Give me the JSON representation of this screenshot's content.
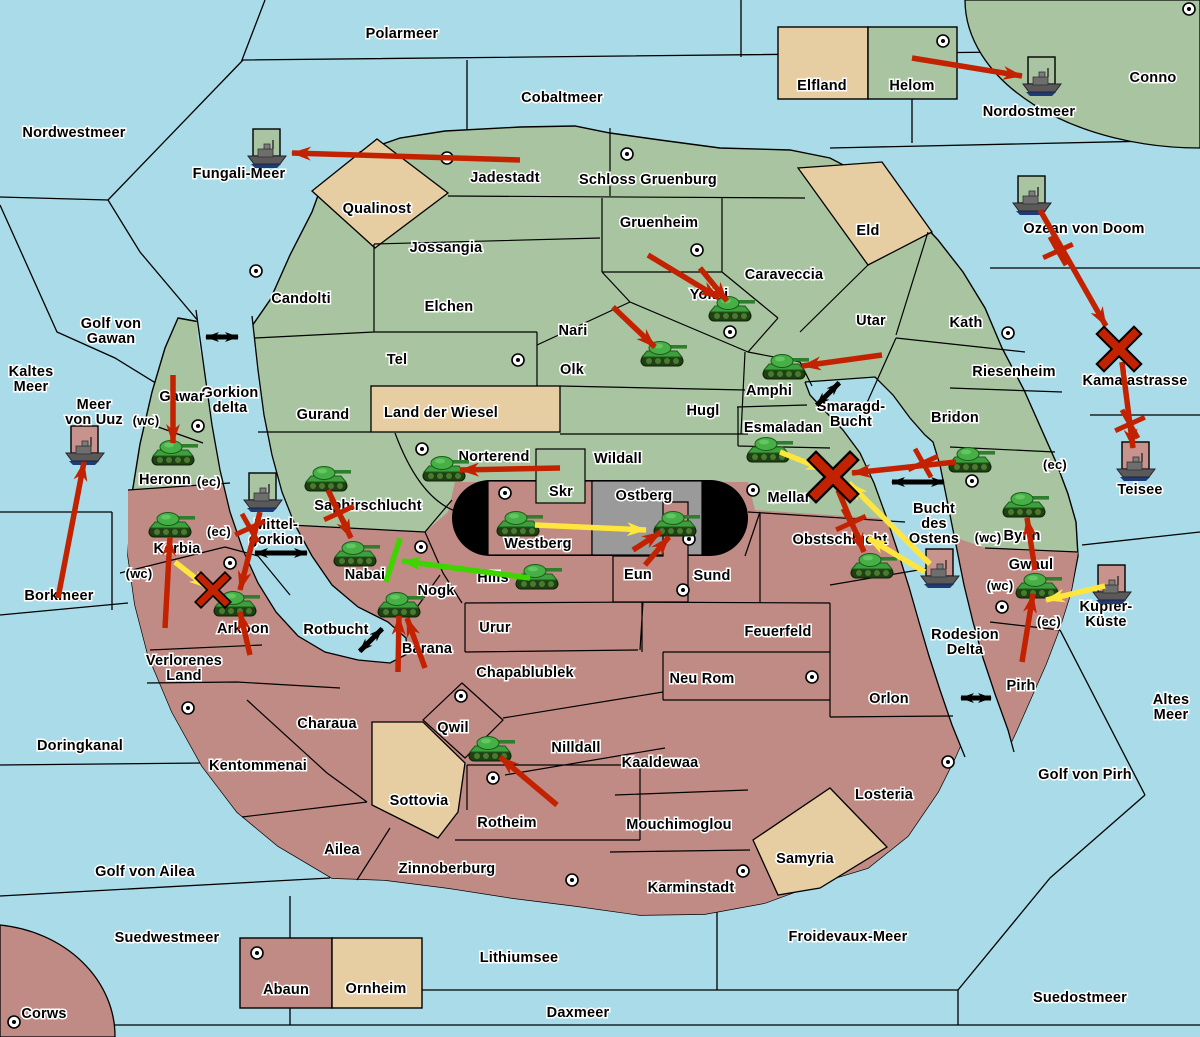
{
  "map": {
    "width": 1200,
    "height": 1037,
    "colors": {
      "sea": "#A9DCE8",
      "green_team_land": "#A9C4A0",
      "red_team_land": "#C08B85",
      "neutral_land": "#E6CDA2",
      "contested_gray": "#9A9A9A",
      "stadium_black": "#000000",
      "border": "#000000",
      "attack_arrow": "#C32200",
      "support_arrow": "#FFE63C",
      "friendly_arrow": "#3ED400",
      "link_arrow": "#000000",
      "tank_green": "#3DA03D",
      "ship_gray": "#5A5A5A",
      "red_flag_square": "#C9938D",
      "green_flag_square": "#A9C4A0"
    },
    "sea_labels": [
      {
        "text": "Polarmeer",
        "x": 402,
        "y": 33
      },
      {
        "text": "Nordwestmeer",
        "x": 74,
        "y": 132
      },
      {
        "text": "Cobaltmeer",
        "x": 562,
        "y": 97
      },
      {
        "text": "Fungali-Meer",
        "x": 239,
        "y": 173
      },
      {
        "text": "Nordostmeer",
        "x": 1029,
        "y": 111
      },
      {
        "text": "Ozean von Doom",
        "x": 1084,
        "y": 228
      },
      {
        "lines": [
          "Kaltes",
          "Meer"
        ],
        "x": 31,
        "y": 371
      },
      {
        "lines": [
          "Golf von",
          "Gawan"
        ],
        "x": 111,
        "y": 323
      },
      {
        "lines": [
          "Meer",
          "von Uuz"
        ],
        "x": 94,
        "y": 404
      },
      {
        "lines": [
          "Gorkion",
          "delta"
        ],
        "x": 230,
        "y": 392
      },
      {
        "text": "Borkmeer",
        "x": 59,
        "y": 595
      },
      {
        "text": "Doringkanal",
        "x": 80,
        "y": 745
      },
      {
        "text": "Golf von Ailea",
        "x": 145,
        "y": 871
      },
      {
        "text": "Suedwestmeer",
        "x": 167,
        "y": 937
      },
      {
        "text": "Lithiumsee",
        "x": 519,
        "y": 957
      },
      {
        "text": "Daxmeer",
        "x": 578,
        "y": 1012
      },
      {
        "text": "Froidevaux-Meer",
        "x": 848,
        "y": 936
      },
      {
        "text": "Suedostmeer",
        "x": 1080,
        "y": 997
      },
      {
        "text": "Golf von Pirh",
        "x": 1085,
        "y": 774
      },
      {
        "lines": [
          "Altes",
          "Meer"
        ],
        "x": 1171,
        "y": 699
      },
      {
        "lines": [
          "Smaragd-",
          "Bucht"
        ],
        "x": 851,
        "y": 406
      },
      {
        "lines": [
          "Bucht",
          "des",
          "Ostens"
        ],
        "x": 934,
        "y": 508
      },
      {
        "text": "Rotbucht",
        "x": 336,
        "y": 629
      },
      {
        "lines": [
          "Rodesion",
          "Delta"
        ],
        "x": 965,
        "y": 634
      },
      {
        "text": "Kamalastrasse",
        "x": 1135,
        "y": 380
      },
      {
        "text": "Teisee",
        "x": 1140,
        "y": 489
      },
      {
        "lines": [
          "Kupfer-",
          "Küste"
        ],
        "x": 1106,
        "y": 606
      },
      {
        "lines": [
          "Mittel-",
          "gorkion"
        ],
        "x": 276,
        "y": 524
      }
    ],
    "land_labels": [
      {
        "text": "Jadestadt",
        "x": 505,
        "y": 177
      },
      {
        "text": "Schloss Gruenburg",
        "x": 648,
        "y": 179
      },
      {
        "text": "Qualinost",
        "x": 377,
        "y": 208
      },
      {
        "text": "Jossangia",
        "x": 446,
        "y": 247
      },
      {
        "text": "Gruenheim",
        "x": 659,
        "y": 222
      },
      {
        "text": "Caraveccia",
        "x": 784,
        "y": 274
      },
      {
        "text": "Eld",
        "x": 868,
        "y": 230
      },
      {
        "text": "Elfland",
        "x": 822,
        "y": 85
      },
      {
        "text": "Helom",
        "x": 912,
        "y": 85
      },
      {
        "text": "Conno",
        "x": 1153,
        "y": 77
      },
      {
        "text": "Candolti",
        "x": 301,
        "y": 298
      },
      {
        "text": "Elchen",
        "x": 449,
        "y": 306
      },
      {
        "text": "Nari",
        "x": 573,
        "y": 330
      },
      {
        "text": "Yokai",
        "x": 709,
        "y": 294
      },
      {
        "text": "Tel",
        "x": 397,
        "y": 359
      },
      {
        "text": "Olk",
        "x": 572,
        "y": 369
      },
      {
        "text": "Utar",
        "x": 871,
        "y": 320
      },
      {
        "text": "Kath",
        "x": 966,
        "y": 322
      },
      {
        "text": "Gurand",
        "x": 323,
        "y": 414
      },
      {
        "text": "Land der Wiesel",
        "x": 441,
        "y": 412
      },
      {
        "text": "Hugl",
        "x": 703,
        "y": 410
      },
      {
        "text": "Amphi",
        "x": 769,
        "y": 390
      },
      {
        "text": "Riesenheim",
        "x": 1014,
        "y": 371
      },
      {
        "text": "Bridon",
        "x": 955,
        "y": 417
      },
      {
        "text": "Esmaladan",
        "x": 783,
        "y": 427
      },
      {
        "text": "Norterend",
        "x": 494,
        "y": 456
      },
      {
        "text": "Wildall",
        "x": 618,
        "y": 458
      },
      {
        "text": "Skr",
        "x": 561,
        "y": 491
      },
      {
        "text": "Ostberg",
        "x": 644,
        "y": 495
      },
      {
        "text": "Mellar",
        "x": 789,
        "y": 497
      },
      {
        "text": "Gawar",
        "x": 182,
        "y": 396
      },
      {
        "text": "Heronn",
        "x": 165,
        "y": 479
      },
      {
        "text": "Saphirschlucht",
        "x": 368,
        "y": 505
      },
      {
        "text": "Bynn",
        "x": 1022,
        "y": 535
      },
      {
        "text": "Korbia",
        "x": 177,
        "y": 548
      },
      {
        "text": "Nabai",
        "x": 365,
        "y": 574
      },
      {
        "text": "Westberg",
        "x": 538,
        "y": 543
      },
      {
        "text": "Hills",
        "x": 493,
        "y": 577
      },
      {
        "text": "Eun",
        "x": 638,
        "y": 574
      },
      {
        "text": "Sund",
        "x": 712,
        "y": 575
      },
      {
        "text": "Obstschlucht",
        "x": 840,
        "y": 539
      },
      {
        "text": "Gwaul",
        "x": 1031,
        "y": 564
      },
      {
        "text": "Pirh",
        "x": 1021,
        "y": 685
      },
      {
        "text": "Arkoon",
        "x": 243,
        "y": 628
      },
      {
        "text": "Nogk",
        "x": 436,
        "y": 590
      },
      {
        "text": "Barana",
        "x": 427,
        "y": 648
      },
      {
        "text": "Urur",
        "x": 495,
        "y": 627
      },
      {
        "lines": [
          "Verlorenes",
          "Land"
        ],
        "x": 184,
        "y": 660
      },
      {
        "text": "Chapablublek",
        "x": 525,
        "y": 672
      },
      {
        "text": "Qwil",
        "x": 453,
        "y": 727
      },
      {
        "text": "Nilldall",
        "x": 576,
        "y": 747
      },
      {
        "text": "Neu Rom",
        "x": 702,
        "y": 678
      },
      {
        "text": "Feuerfeld",
        "x": 778,
        "y": 631
      },
      {
        "text": "Kaaldewaa",
        "x": 660,
        "y": 762
      },
      {
        "text": "Mouchimoglou",
        "x": 679,
        "y": 824
      },
      {
        "text": "Orlon",
        "x": 889,
        "y": 698
      },
      {
        "text": "Losteria",
        "x": 884,
        "y": 794
      },
      {
        "text": "Charaua",
        "x": 327,
        "y": 723
      },
      {
        "text": "Kentommenai",
        "x": 258,
        "y": 765
      },
      {
        "text": "Sottovia",
        "x": 419,
        "y": 800
      },
      {
        "text": "Rotheim",
        "x": 507,
        "y": 822
      },
      {
        "text": "Ailea",
        "x": 342,
        "y": 849
      },
      {
        "text": "Zinnoberburg",
        "x": 447,
        "y": 868
      },
      {
        "text": "Karminstadt",
        "x": 691,
        "y": 887
      },
      {
        "text": "Samyria",
        "x": 805,
        "y": 858
      },
      {
        "text": "Mouchimoglou_dup_skip",
        "x": -100,
        "y": -100
      },
      {
        "text": "Abaun",
        "x": 286,
        "y": 989
      },
      {
        "text": "Ornheim",
        "x": 376,
        "y": 988
      },
      {
        "text": "Corws",
        "x": 44,
        "y": 1013
      }
    ],
    "coast_tags": [
      {
        "text": "(wc)",
        "x": 146,
        "y": 420
      },
      {
        "text": "(ec)",
        "x": 209,
        "y": 481
      },
      {
        "text": "(ec)",
        "x": 219,
        "y": 531
      },
      {
        "text": "(wc)",
        "x": 139,
        "y": 573
      },
      {
        "text": "(ec)",
        "x": 1055,
        "y": 464
      },
      {
        "text": "(wc)",
        "x": 988,
        "y": 537
      },
      {
        "text": "(wc)",
        "x": 1000,
        "y": 585
      },
      {
        "text": "(ec)",
        "x": 1049,
        "y": 621
      }
    ],
    "capital_dots": [
      {
        "x": 447,
        "y": 158
      },
      {
        "x": 627,
        "y": 154
      },
      {
        "x": 943,
        "y": 41
      },
      {
        "x": 1189,
        "y": 9
      },
      {
        "x": 256,
        "y": 271
      },
      {
        "x": 697,
        "y": 250
      },
      {
        "x": 518,
        "y": 360
      },
      {
        "x": 730,
        "y": 332
      },
      {
        "x": 1008,
        "y": 333
      },
      {
        "x": 198,
        "y": 426
      },
      {
        "x": 422,
        "y": 449
      },
      {
        "x": 505,
        "y": 493
      },
      {
        "x": 753,
        "y": 490
      },
      {
        "x": 972,
        "y": 481
      },
      {
        "x": 421,
        "y": 547
      },
      {
        "x": 689,
        "y": 539
      },
      {
        "x": 683,
        "y": 590
      },
      {
        "x": 230,
        "y": 563
      },
      {
        "x": 188,
        "y": 708
      },
      {
        "x": 461,
        "y": 696
      },
      {
        "x": 493,
        "y": 778
      },
      {
        "x": 572,
        "y": 880
      },
      {
        "x": 743,
        "y": 871
      },
      {
        "x": 948,
        "y": 762
      },
      {
        "x": 812,
        "y": 677
      },
      {
        "x": 1002,
        "y": 607
      },
      {
        "x": 257,
        "y": 953
      },
      {
        "x": 14,
        "y": 1022
      }
    ],
    "tanks": [
      {
        "region": "Gawar",
        "x": 173,
        "y": 454
      },
      {
        "region": "Korbia",
        "x": 170,
        "y": 526
      },
      {
        "region": "Arkoon",
        "x": 235,
        "y": 605
      },
      {
        "region": "Saphirschlucht",
        "x": 326,
        "y": 480
      },
      {
        "region": "Nabai",
        "x": 355,
        "y": 555
      },
      {
        "region": "Nogk",
        "x": 399,
        "y": 606
      },
      {
        "region": "Norterend",
        "x": 444,
        "y": 470
      },
      {
        "region": "Westberg",
        "x": 518,
        "y": 525
      },
      {
        "region": "Ostberg",
        "x": 675,
        "y": 525
      },
      {
        "region": "Hills",
        "x": 537,
        "y": 578
      },
      {
        "region": "Yokai",
        "x": 730,
        "y": 310
      },
      {
        "region": "Olk",
        "x": 662,
        "y": 355
      },
      {
        "region": "Amphi",
        "x": 784,
        "y": 368
      },
      {
        "region": "Esmaladan",
        "x": 768,
        "y": 451
      },
      {
        "region": "Bridon",
        "x": 970,
        "y": 461
      },
      {
        "region": "Obstschlucht",
        "x": 872,
        "y": 567
      },
      {
        "region": "Bynn",
        "x": 1024,
        "y": 506
      },
      {
        "region": "Gwaul",
        "x": 1037,
        "y": 587
      },
      {
        "region": "Qwil",
        "x": 490,
        "y": 750
      }
    ],
    "ships": [
      {
        "sea": "Fungali-Meer",
        "x": 267,
        "y": 153,
        "flag": "green"
      },
      {
        "sea": "Nordostmeer",
        "x": 1042,
        "y": 81,
        "flag": "green"
      },
      {
        "sea": "Ozean von Doom",
        "x": 1032,
        "y": 200,
        "flag": "green"
      },
      {
        "sea": "Meer von Uuz",
        "x": 85,
        "y": 450,
        "flag": "red"
      },
      {
        "sea": "Mittel-gorkion",
        "x": 263,
        "y": 497,
        "flag": "green"
      },
      {
        "sea": "Teisee",
        "x": 1136,
        "y": 466,
        "flag": "red"
      },
      {
        "sea": "Bucht des Ostens",
        "x": 940,
        "y": 573,
        "flag": "red"
      },
      {
        "sea": "Kupfer-Küste",
        "x": 1112,
        "y": 589,
        "flag": "red"
      }
    ],
    "arrows": [
      {
        "color": "red",
        "x1": 520,
        "y1": 160,
        "x2": 292,
        "y2": 153
      },
      {
        "color": "red",
        "x1": 912,
        "y1": 58,
        "x2": 1022,
        "y2": 76
      },
      {
        "color": "red",
        "x1": 1040,
        "y1": 210,
        "x2": 1106,
        "y2": 326
      },
      {
        "color": "red",
        "x1": 1122,
        "y1": 362,
        "x2": 1133,
        "y2": 448
      },
      {
        "color": "red",
        "x1": 173,
        "y1": 375,
        "x2": 173,
        "y2": 443
      },
      {
        "color": "red",
        "x1": 58,
        "y1": 598,
        "x2": 84,
        "y2": 462
      },
      {
        "color": "red",
        "x1": 165,
        "y1": 628,
        "x2": 170,
        "y2": 537
      },
      {
        "color": "red",
        "x1": 260,
        "y1": 512,
        "x2": 240,
        "y2": 590
      },
      {
        "color": "red",
        "x1": 250,
        "y1": 655,
        "x2": 240,
        "y2": 612
      },
      {
        "color": "red",
        "x1": 328,
        "y1": 490,
        "x2": 351,
        "y2": 538
      },
      {
        "color": "red",
        "x1": 398,
        "y1": 672,
        "x2": 399,
        "y2": 616
      },
      {
        "color": "red",
        "x1": 425,
        "y1": 668,
        "x2": 407,
        "y2": 618
      },
      {
        "color": "red",
        "x1": 560,
        "y1": 468,
        "x2": 460,
        "y2": 470
      },
      {
        "color": "red",
        "x1": 633,
        "y1": 550,
        "x2": 661,
        "y2": 532
      },
      {
        "color": "red",
        "x1": 645,
        "y1": 565,
        "x2": 669,
        "y2": 537
      },
      {
        "color": "red",
        "x1": 648,
        "y1": 255,
        "x2": 719,
        "y2": 298
      },
      {
        "color": "red",
        "x1": 700,
        "y1": 268,
        "x2": 727,
        "y2": 301
      },
      {
        "color": "red",
        "x1": 613,
        "y1": 307,
        "x2": 655,
        "y2": 347
      },
      {
        "color": "red",
        "x1": 882,
        "y1": 355,
        "x2": 802,
        "y2": 366
      },
      {
        "color": "red",
        "x1": 956,
        "y1": 462,
        "x2": 852,
        "y2": 473
      },
      {
        "color": "red",
        "x1": 838,
        "y1": 490,
        "x2": 864,
        "y2": 552
      },
      {
        "color": "red",
        "x1": 1035,
        "y1": 570,
        "x2": 1027,
        "y2": 518
      },
      {
        "color": "red",
        "x1": 1022,
        "y1": 662,
        "x2": 1033,
        "y2": 594
      },
      {
        "color": "red",
        "x1": 557,
        "y1": 805,
        "x2": 500,
        "y2": 757
      },
      {
        "color": "yellow",
        "x1": 780,
        "y1": 452,
        "x2": 825,
        "y2": 470
      },
      {
        "color": "yellow",
        "x1": 930,
        "y1": 564,
        "x2": 849,
        "y2": 483
      },
      {
        "color": "yellow",
        "x1": 925,
        "y1": 572,
        "x2": 868,
        "y2": 538
      },
      {
        "color": "yellow",
        "x1": 1105,
        "y1": 586,
        "x2": 1046,
        "y2": 600
      },
      {
        "color": "yellow",
        "x1": 175,
        "y1": 562,
        "x2": 208,
        "y2": 588
      },
      {
        "color": "yellow",
        "x1": 535,
        "y1": 525,
        "x2": 646,
        "y2": 530
      },
      {
        "color": "green",
        "x1": 530,
        "y1": 578,
        "x2": 402,
        "y2": 561
      }
    ],
    "link_arrows": [
      {
        "x": 222,
        "y": 337,
        "angle": 0,
        "len": 16
      },
      {
        "x": 281,
        "y": 553,
        "angle": 0,
        "len": 26
      },
      {
        "x": 371,
        "y": 640,
        "angle": -45,
        "len": 16
      },
      {
        "x": 828,
        "y": 394,
        "angle": -45,
        "len": 16
      },
      {
        "x": 918,
        "y": 482,
        "angle": 0,
        "len": 26
      },
      {
        "x": 976,
        "y": 698,
        "angle": 0,
        "len": 15
      }
    ],
    "battle_marks": [
      {
        "x": 833,
        "y": 477,
        "size": 17
      },
      {
        "x": 1119,
        "y": 349,
        "size": 15
      },
      {
        "x": 213,
        "y": 590,
        "size": 12
      }
    ],
    "blocked_marks": [
      {
        "x": 1058,
        "y": 251,
        "color": "red"
      },
      {
        "x": 1130,
        "y": 424,
        "color": "red"
      },
      {
        "x": 923,
        "y": 463,
        "color": "red"
      },
      {
        "x": 851,
        "y": 523,
        "color": "red"
      },
      {
        "x": 250,
        "y": 528,
        "color": "red"
      },
      {
        "x": 339,
        "y": 513,
        "color": "red"
      },
      {
        "x": 393,
        "y": 560,
        "color": "green"
      }
    ]
  }
}
